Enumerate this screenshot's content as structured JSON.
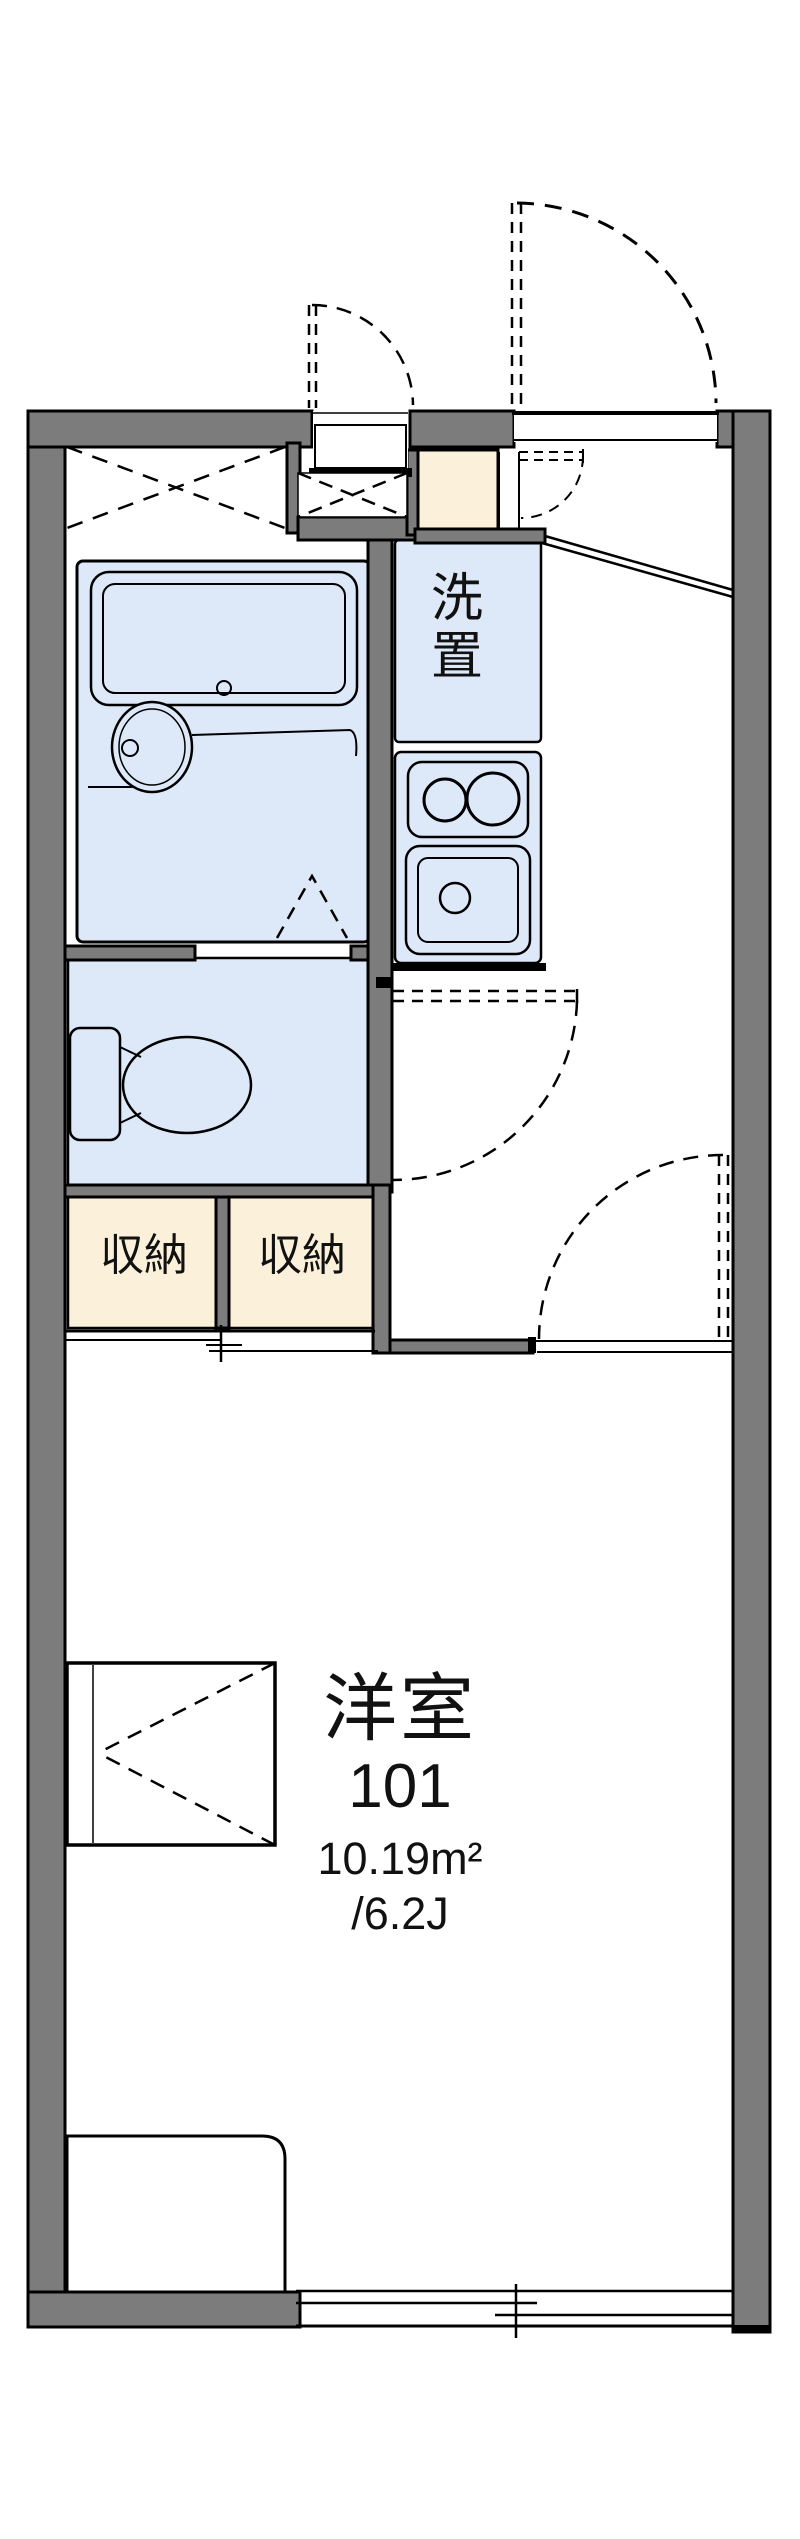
{
  "floor_plan": {
    "room": {
      "type_label": "洋室",
      "number": "101",
      "area_m2": "10.19m²",
      "area_tatami": "/6.2J"
    },
    "labels": {
      "washer_place": "洗置",
      "closet_left": "収納",
      "closet_right": "収納"
    },
    "colors": {
      "wall": "#7c7c7c",
      "water_blue": "#dde8f8",
      "storage_cream": "#fbf0d9",
      "line": "#000000",
      "background": "#ffffff"
    }
  }
}
